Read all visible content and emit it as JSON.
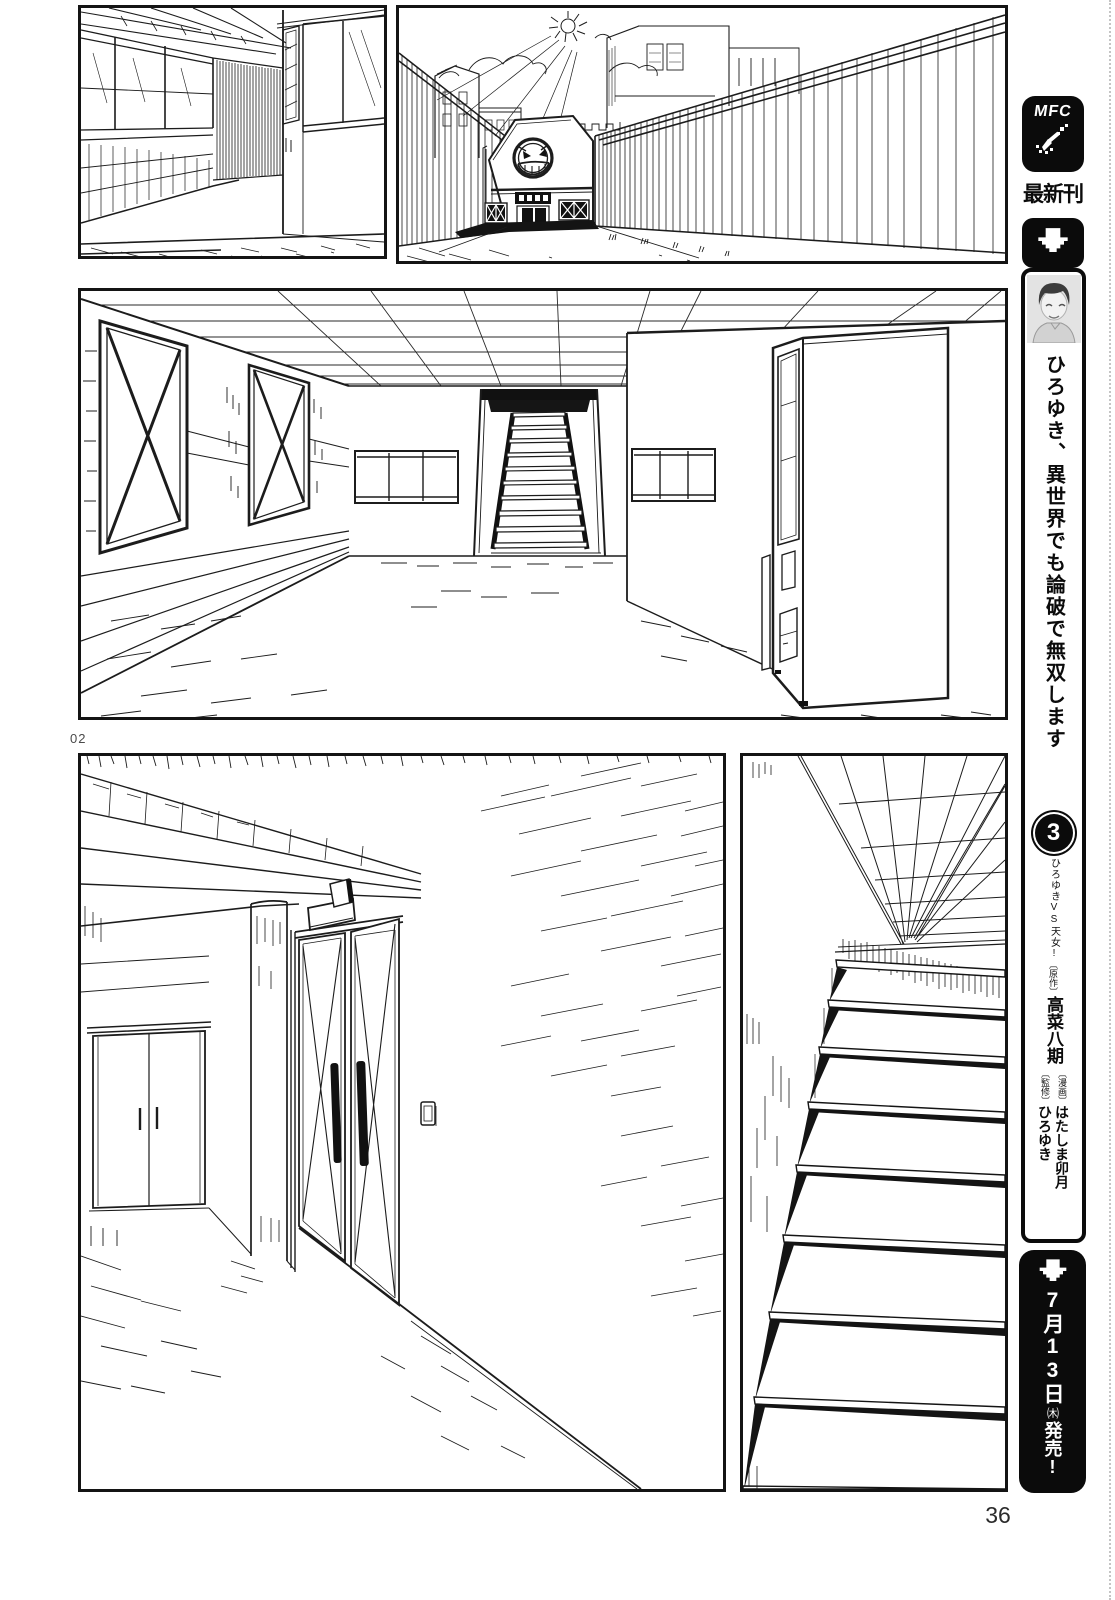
{
  "page": {
    "number": "36",
    "panel_label": "02",
    "paper_color": "#ffffff",
    "ink_color": "#1a1a1a"
  },
  "sidebar": {
    "logo_text": "MFC",
    "logo_icon": "pixel-quill-icon",
    "latest_label": "最新刊",
    "arrow_icon": "pixel-down-arrow-icon",
    "book": {
      "portrait_icon": "author-portrait",
      "title": "ひろゆき、異世界でも論破で無双します",
      "volume": "3",
      "tagline": "ひろゆきVS天女!",
      "credits": [
        {
          "role": "〔原作〕",
          "name": "高菜八期"
        },
        {
          "role": "〔漫画〕",
          "name": "はたしま卯月"
        },
        {
          "role": "〔監修〕",
          "name": "ひろゆき"
        }
      ],
      "release": {
        "month_day": "7月13日",
        "weekday": "㈭",
        "label": "発売!"
      }
    }
  },
  "icons": {
    "building_logo": "grinning-smiley-logo"
  }
}
